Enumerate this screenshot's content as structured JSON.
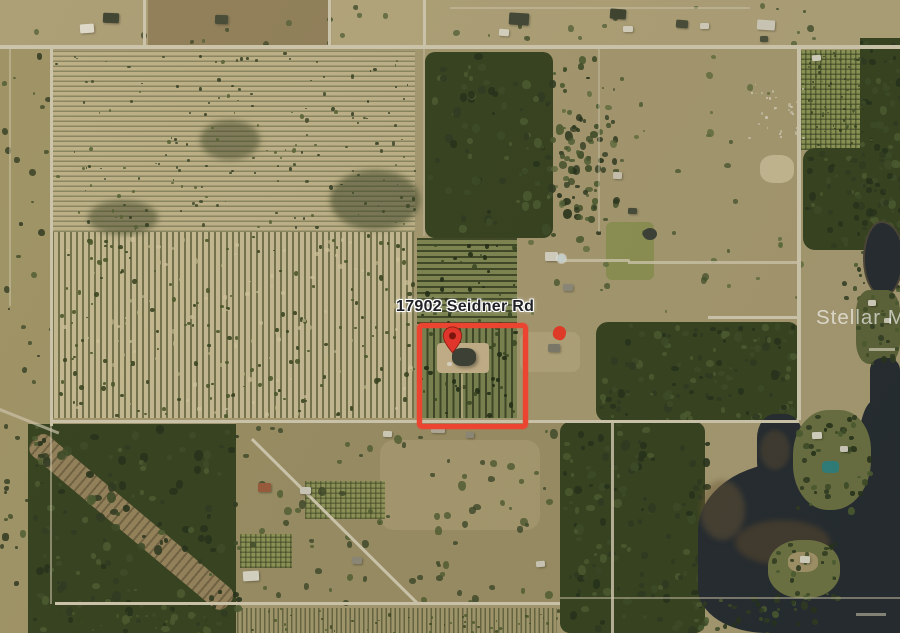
{
  "map": {
    "address_label": "17902 Seidner Rd",
    "watermark": "Stellar MLS",
    "parcel": {
      "outline_color": "#EB4531"
    },
    "markers": {
      "primary_pin": {
        "icon": "location-pin-icon",
        "color": "#E0352B",
        "inner_dot_color": "#7B150D"
      },
      "secondary_marker": {
        "icon": "red-dot-marker",
        "color": "#DD3A28"
      }
    },
    "label_style": {
      "text_color": "#1F2125",
      "halo_color": "#FFFFFF"
    },
    "watermark_color": "rgba(255,255,255,0.62)"
  }
}
